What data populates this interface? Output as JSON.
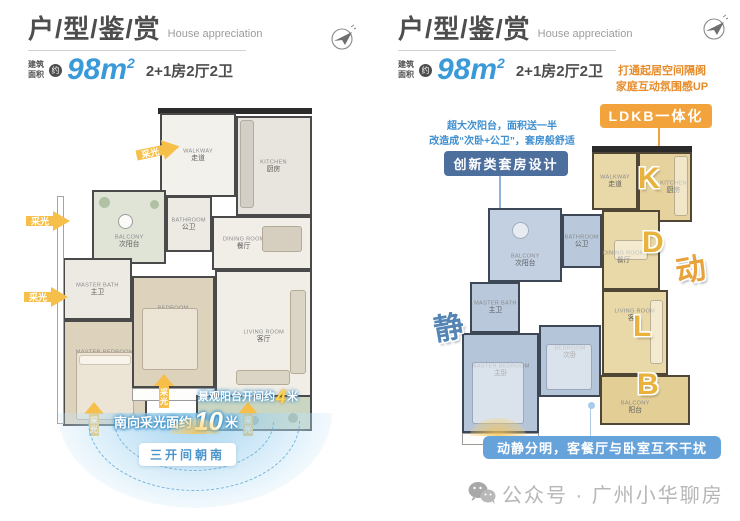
{
  "header": {
    "title": "户/型/鉴/赏",
    "subtitle": "House appreciation"
  },
  "area": {
    "label_line1": "建筑",
    "label_line2": "面积",
    "approx": "约",
    "value": "98m",
    "sup": "2",
    "spec": "2+1房2厅2卫"
  },
  "left": {
    "light_label": "采光",
    "light_chars": [
      "采",
      "光"
    ],
    "rooms": [
      {
        "en": "WALKWAY",
        "cn": "走道"
      },
      {
        "en": "KITCHEN",
        "cn": "厨房"
      },
      {
        "en": "BALCONY",
        "cn": "次阳台"
      },
      {
        "en": "BATHROOM",
        "cn": "公卫"
      },
      {
        "en": "DINING ROOM",
        "cn": "餐厅"
      },
      {
        "en": "MASTER BATH",
        "cn": "主卫"
      },
      {
        "en": "MASTER BEDROOM",
        "cn": "主卧"
      },
      {
        "en": "BEDROOM",
        "cn": "次卧"
      },
      {
        "en": "LIVING ROOM",
        "cn": "客厅"
      }
    ],
    "balcony_note": {
      "prefix": "景观阳台开间约",
      "num": "4",
      "unit": "米"
    },
    "south_note": {
      "prefix": "南向采光面约",
      "num": "10",
      "unit": "米"
    },
    "orientation_pill": "三开间朝南"
  },
  "right": {
    "callout_ldkb": {
      "line1": "打通起居空间隔阂",
      "line2": "家庭互动氛围感UP",
      "badge": "LDKB一体化"
    },
    "callout_suite": {
      "line1": "超大次阳台，面积送一半",
      "line2": "改造成“次卧+公卫”，套房般舒适",
      "badge": "创新类套房设计"
    },
    "letters": [
      "K",
      "D",
      "L",
      "B"
    ],
    "zone_dynamic": "动",
    "zone_static": "静",
    "bottom_badge": "动静分明，客餐厅与卧室互不干扰",
    "rooms": [
      {
        "en": "WALKWAY",
        "cn": "走道"
      },
      {
        "en": "KITCHEN",
        "cn": "厨房"
      },
      {
        "en": "BATHROOM",
        "cn": "公卫"
      },
      {
        "en": "BALCONY",
        "cn": "次阳台"
      },
      {
        "en": "MASTER BATH",
        "cn": "主卫"
      },
      {
        "en": "MASTER BEDROOM",
        "cn": "主卧"
      },
      {
        "en": "BEDROOM",
        "cn": "次卧"
      },
      {
        "en": "DINING ROOM",
        "cn": "餐厅"
      },
      {
        "en": "LIVING ROOM",
        "cn": "客厅"
      },
      {
        "en": "BALCONY",
        "cn": "阳台"
      }
    ]
  },
  "footer": {
    "account": "公众号 · 广州小华聊房"
  },
  "colors": {
    "accent_blue": "#3a9ad9",
    "accent_orange": "#f2a33c",
    "badge_slate": "#4d6f9e",
    "badge_blue": "#66a3da",
    "zone_yellow": "#ead9a8",
    "zone_blue": "#b9c8db"
  }
}
